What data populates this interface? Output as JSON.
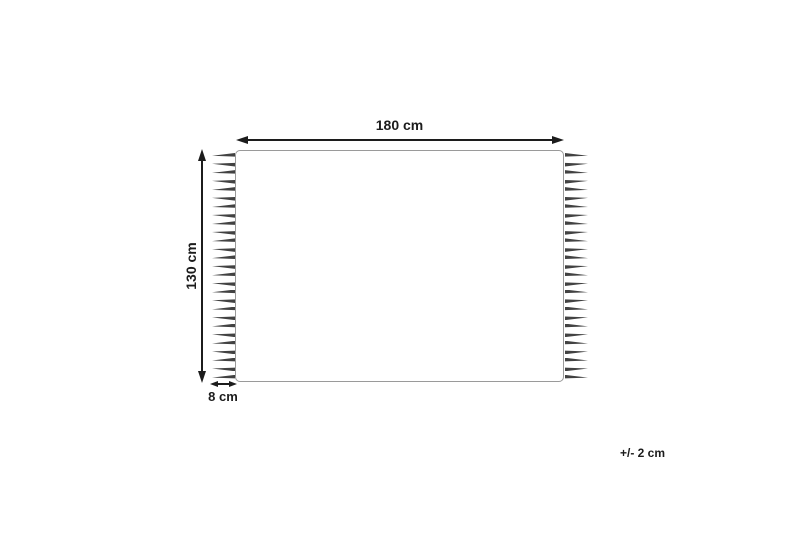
{
  "diagram": {
    "type": "product-dimension-diagram",
    "labels": {
      "width": "180 cm",
      "height": "130 cm",
      "fringe": "8 cm",
      "tolerance": "+/- 2 cm"
    },
    "fringe_tassel_count": 27,
    "colors": {
      "bg": "#ffffff",
      "ink": "#1c1c1c",
      "outline": "#9a9a9a",
      "tassel": "#424242"
    }
  }
}
